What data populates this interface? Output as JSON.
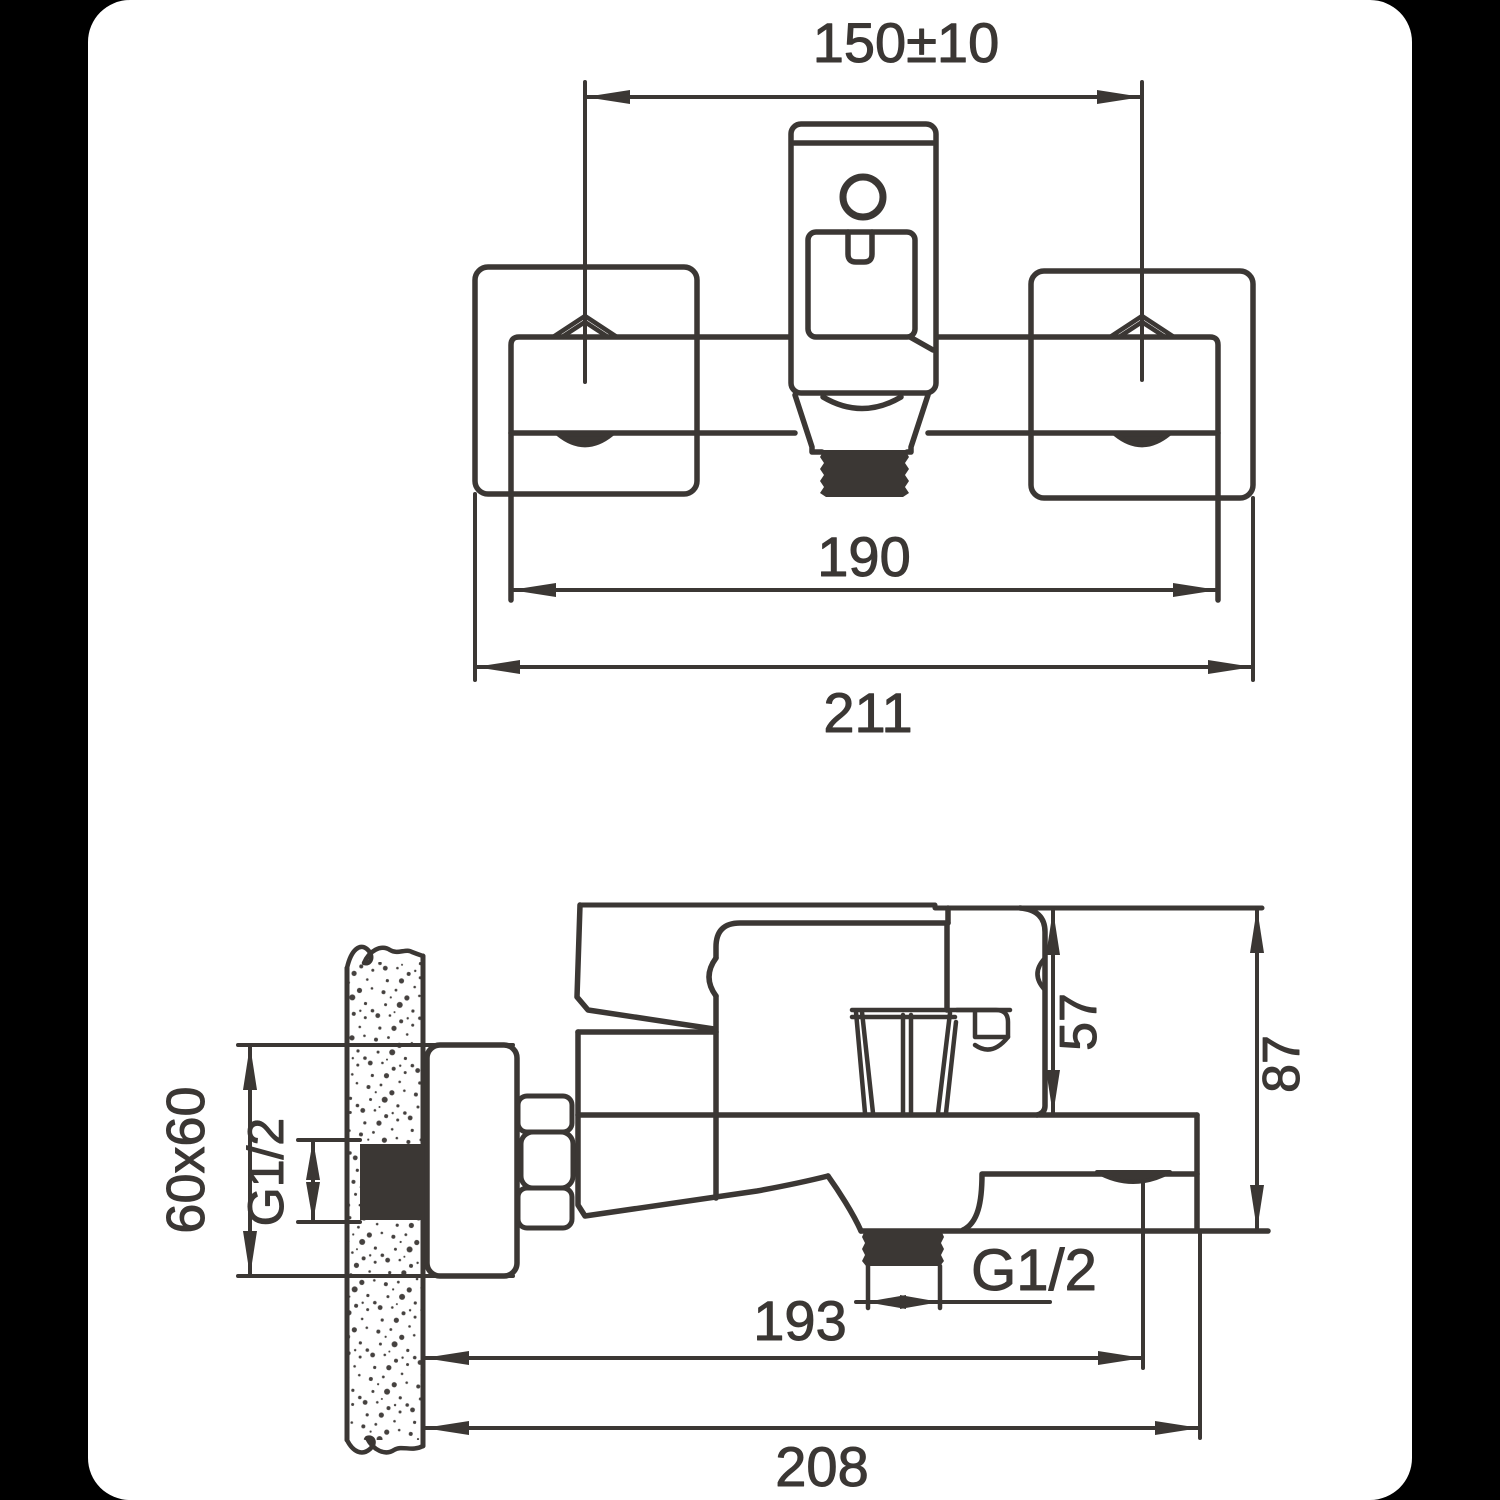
{
  "title": "Shower mixer installation dimensions drawing",
  "colors": {
    "background": "#000000",
    "card": "#ffffff",
    "ink": "#3b3734"
  },
  "diagram": {
    "front_view": {
      "mounting_distance": "150±10",
      "body_width": "190",
      "overall_width": "211"
    },
    "side_view": {
      "escutcheon_size": "60x60",
      "inlet_thread": "G1/2",
      "height_to_body": "57",
      "overall_height": "87",
      "outlet_thread": "G1/2",
      "reach_to_outlet": "193",
      "overall_depth": "208"
    }
  }
}
